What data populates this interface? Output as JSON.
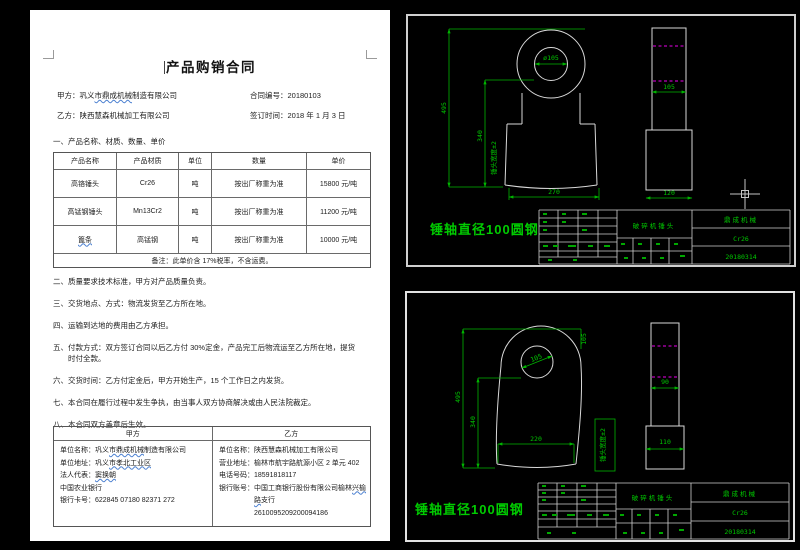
{
  "doc": {
    "title": "产品购销合同",
    "meta": {
      "pa_label": "甲方：",
      "pa": [
        "巩义",
        "市鼎成机械",
        "制造有限公司"
      ],
      "no_label": "合同编号：",
      "no": "20180103",
      "pb_label": "乙方：",
      "pb": "陕西慧森机械加工有限公司",
      "date_label": "签订时间：",
      "date": "2018 年 1 月 3 日"
    },
    "sec1": "一、产品名称、材质、数量、单价",
    "table": {
      "headers": [
        "产品名称",
        "产品材质",
        "单位",
        "数量",
        "单价"
      ],
      "rows": [
        [
          "高铬锤头",
          "Cr26",
          "吨",
          "按出厂称重为准",
          "15800 元/吨"
        ],
        [
          "高锰钢锤头",
          "Mn13Cr2",
          "吨",
          "按出厂称重为准",
          "11200 元/吨"
        ],
        [
          "篦条",
          "高锰钢",
          "吨",
          "按出厂称重为准",
          "10000 元/吨"
        ]
      ],
      "note": "备注：此单价含 17%税率，不含运费。"
    },
    "clauses": [
      "二、质量要求技术标准，甲方对产品质量负责。",
      "三、交货地点、方式：物流发货至乙方所在地。",
      "四、运输到达地的费用由乙方承担。",
      "五、付款方式：双方签订合同以后乙方付 30%定金，产品完工后物流运至乙方所在地，提货时付全款。",
      "六、交货时间：乙方付定金后，甲方开始生产，15 个工作日之内发货。",
      "七、本合同在履行过程中发生争执，由当事人双方协商解决或由人民法院裁定。",
      "八、本合同双方盖章后生效。"
    ],
    "parties": {
      "ha": "甲方",
      "hb": "乙方",
      "a": {
        "name_label": "单位名称：",
        "name": [
          "巩义",
          "市鼎成机械",
          "制造有限公司"
        ],
        "addr_label": "单位地址：",
        "addr": [
          "巩义",
          "市孝北工业区"
        ],
        "legal_label": "法人代表：",
        "legal": "窦换朝",
        "bank": "中国农业银行",
        "card_label": "银行卡号：",
        "card": "622845 07180 82371 272"
      },
      "b": {
        "name_label": "单位名称：",
        "name": "陕西慧森机械加工有限公司",
        "addr_label": "营业地址：",
        "addr": "榆林市航宇路航源小区 2 单元 402",
        "phone_label": "电话号码：",
        "phone": "18591818117",
        "bank_label": "银行账号：",
        "bank": [
          "中国工商银行股份有限公司榆林",
          "兴榆路",
          "支行"
        ],
        "account": "2610095209200094186"
      }
    }
  },
  "cad": {
    "top": {
      "front": {
        "hole": "ø105",
        "h": "495",
        "mid": "340",
        "note": "锤头宽度±2",
        "bw": "270"
      },
      "side": {
        "hole": "105",
        "base": "120"
      },
      "label": "锤轴直径100圆钢",
      "block": {
        "part": "破碎机锤头",
        "company": "鼎成机械",
        "material": "Cr26",
        "date": "20180314"
      }
    },
    "bottom": {
      "front": {
        "hole": "105",
        "top": "105",
        "h": "495",
        "mid": "340",
        "bw": "220"
      },
      "side": {
        "upper": "90",
        "base": "110",
        "note": "锤头宽度±2"
      },
      "label": "锤轴直径100圆钢",
      "block": {
        "part": "破碎机锤头",
        "company": "鼎成机械",
        "material": "Cr26",
        "date": "20180314"
      }
    },
    "colors": {
      "line": "#d9d9d9",
      "dim": "#00b400",
      "hidden": "#bb00bb",
      "bg": "#000000"
    }
  }
}
